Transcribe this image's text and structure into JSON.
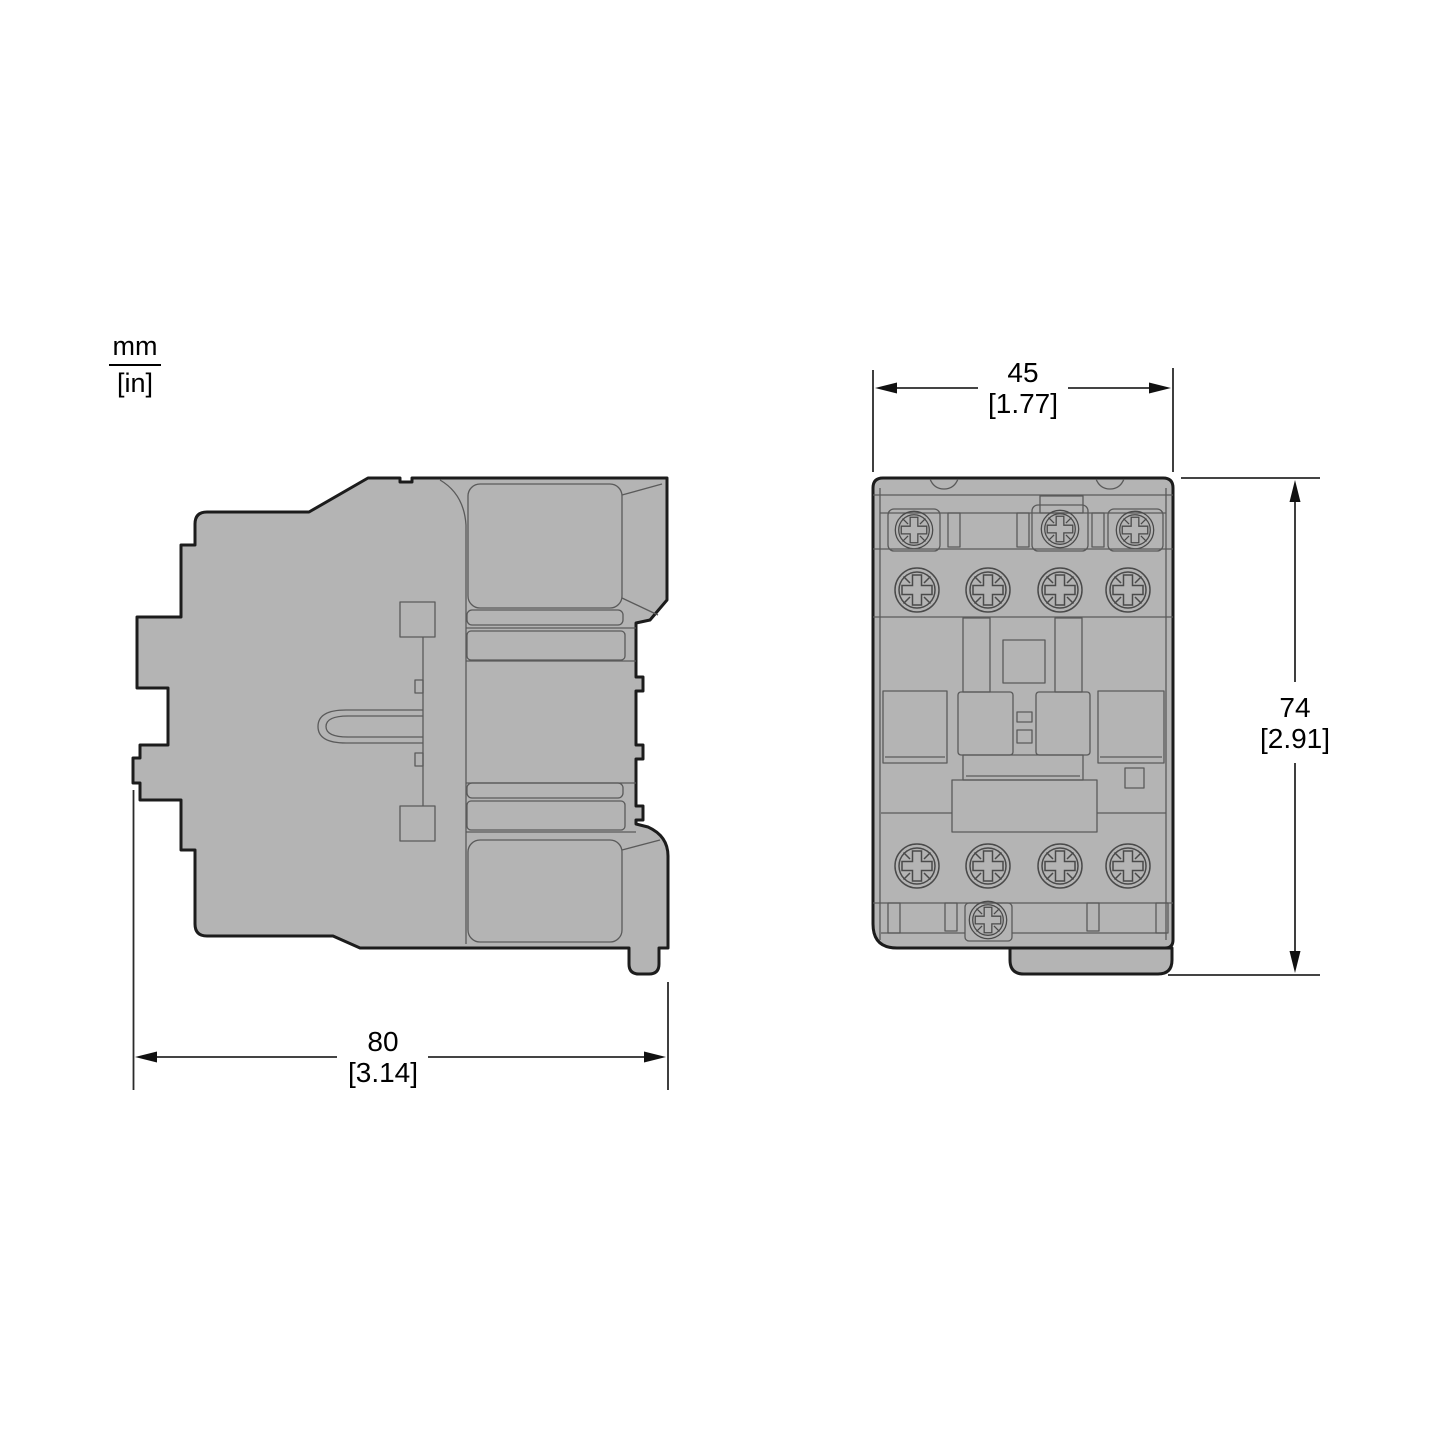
{
  "unit_indicator": {
    "numerator": "mm",
    "denominator": "[in]"
  },
  "front_view": {
    "width_dimension": {
      "mm": "45",
      "in": "[1.77]"
    },
    "height_dimension": {
      "mm": "74",
      "in": "[2.91]"
    }
  },
  "side_view": {
    "depth_dimension": {
      "mm": "80",
      "in": "[3.14]"
    }
  },
  "icons": {
    "screw_head": "pozidriv-screw-head"
  },
  "colors": {
    "body_fill": "#b4b4b4",
    "outline": "#1c1c1c",
    "detail_line": "#5a5a5a",
    "dimension_line": "#2a2a2a",
    "text": "#000000",
    "background": "#ffffff"
  }
}
